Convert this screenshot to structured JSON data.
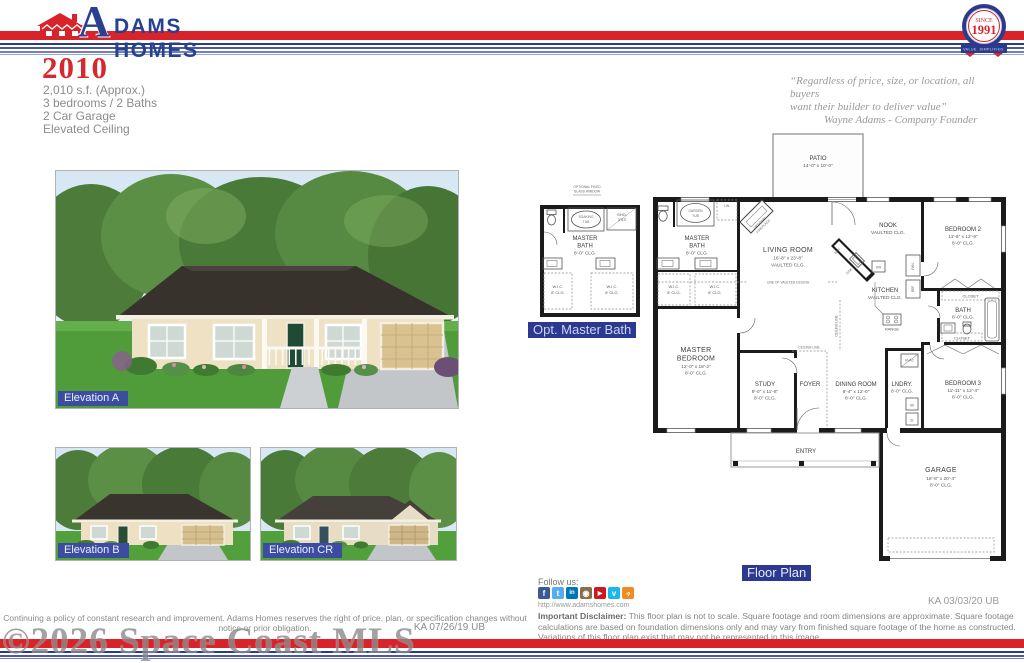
{
  "header": {
    "brand": {
      "initial": "A",
      "rest": "DAMS HOMES"
    },
    "badge": {
      "since": "SINCE",
      "year": "1991",
      "ribbon": "VALUE. SIMPLIFIED."
    }
  },
  "title": {
    "model": "2010",
    "spec1": "2,010 s.f. (Approx.)",
    "spec2": "3 bedrooms / 2 Baths",
    "spec3": "2 Car Garage",
    "spec4": "Elevated Ceiling"
  },
  "quote": {
    "line1": "“Regardless of price, size, or location, all buyers",
    "line2": "want their builder to deliver value”",
    "attribution": "Wayne Adams - Company Founder"
  },
  "elevations": {
    "a": "Elevation A",
    "b": "Elevation B",
    "cr": "Elevation CR"
  },
  "optbath": {
    "label": "Opt. Master Bath",
    "window1": "OPTIONAL FIXED",
    "window2": "GLASS WINDOW",
    "tub1": "SOAKING",
    "tub2": "TUB",
    "sho1": "SHO.",
    "sho2": "3'X3'"
  },
  "fp": {
    "label": "Floor Plan",
    "stamp": "KA 03/03/20 UB",
    "patio": {
      "n": "PATIO",
      "d": "14'-0\" x 10'-0\""
    },
    "living": {
      "n": "LIVING ROOM",
      "d": "16'-8\" x 23'-8\"",
      "c": "VAULTED CLG."
    },
    "nook": {
      "n": "NOOK",
      "c": "VAULTED CLG."
    },
    "kitchen": {
      "n": "KITCHEN",
      "c": "VAULTED CLG."
    },
    "bed2": {
      "n": "BEDROOM 2",
      "d": "11'-6\" x 12'-9\"",
      "c": "8'-0\" CLG."
    },
    "bed3": {
      "n": "BEDROOM 3",
      "d": "11'-11\" x 12'-4\"",
      "c": "8'-0\" CLG."
    },
    "master": {
      "n1": "MASTER",
      "n2": "BEDROOM",
      "d": "12'-0\" x 18'-2\"",
      "c": "8'-0\" CLG."
    },
    "mbath": {
      "n1": "MASTER",
      "n2": "BATH",
      "c": "8'-0\" CLG."
    },
    "study": {
      "n": "STUDY",
      "d": "9'-0\" x 11'-8\"",
      "c": "8'-0\" CLG."
    },
    "dining": {
      "n": "DINING ROOM",
      "d": "9'-4\" x 12'-0\"",
      "c": "8'-0\" CLG."
    },
    "foyer": "FOYER",
    "entry": "ENTRY",
    "lndry": {
      "n": "LNDRY.",
      "c": "8'-0\" CLG."
    },
    "bath": {
      "n": "BATH",
      "c": "8'-0\" CLG."
    },
    "garage": {
      "n": "GARAGE",
      "d": "18'-8\" x 20'-4\"",
      "c": "8'-0\" CLG."
    },
    "t": {
      "wic": "W.I.C.",
      "clg8ft": "8' CLG.",
      "closet": "CLOSET",
      "lin": "LIN.",
      "gardentub1": "GARDEN",
      "gardentub2": "TUB",
      "fire1": "OPTIONAL",
      "fire2": "FIREPLACE",
      "bar": "BAR",
      "sink": "SINK",
      "dw": "DW",
      "pan": "PAN.",
      "ref": "REF",
      "range": "RANGE",
      "w": "W",
      "d": "D",
      "hvac": "HVAC",
      "lovc": "LINE OF VAULTED CEILING",
      "cl": "CEILING LINE"
    }
  },
  "footer": {
    "follow": "Follow us:",
    "website": "http://www.adamshomes.com",
    "social": [
      "facebook",
      "twitter",
      "linkedin",
      "instagram",
      "youtube",
      "vimeo",
      "rss"
    ],
    "disclaimer_label": "Important Disclaimer:",
    "disclaimer": "This floor plan is not to scale. Square footage and room dimensions are approximate. Square footage calculations are based on foundation dimensions only and may vary from finished square footage of the home as constructed. Variations of this floor plan exist that may not be represented in this image.",
    "left_note": "Continuing a policy of constant research and improvement. Adams Homes reserves the right of price, plan, or specification changes without notice or prior obligation.",
    "left_stamp": "KA 07/26/19 UB",
    "watermark": "©2026 Space Coast MLS"
  },
  "colors": {
    "red": "#d8232a",
    "navy": "#27408f",
    "label_blue": "#2b3990"
  }
}
